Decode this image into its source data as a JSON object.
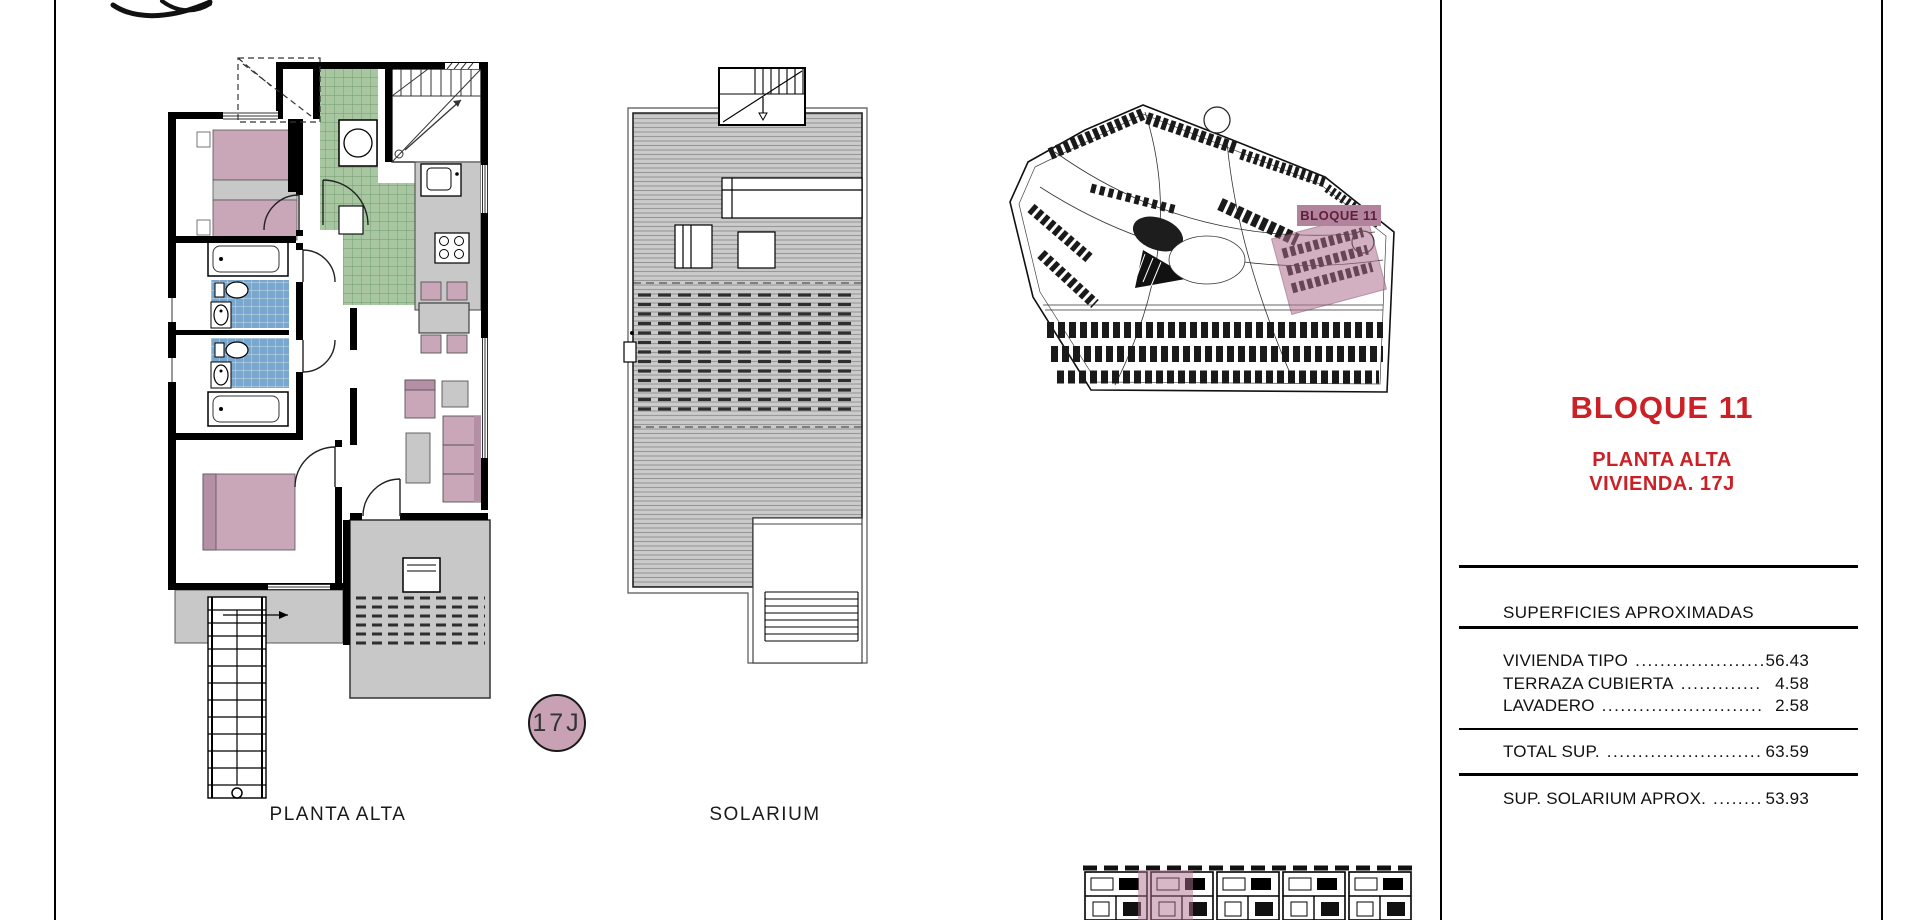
{
  "page": {
    "background": "#ffffff",
    "border_color": "#000000"
  },
  "colors": {
    "accent_red": "#cb2026",
    "mauve": "#c9a6b8",
    "mauve_highlight": "#b0718f",
    "site_tag_bg": "#b2839c",
    "site_tag_text": "#5e1f38",
    "tile_blue": "#79a7ce",
    "tile_green": "#a8c7a0",
    "floor_gray": "#c8c8c8",
    "line_black": "#000000"
  },
  "drawings": {
    "planta_alta": {
      "caption": "PLANTA ALTA"
    },
    "solarium": {
      "caption": "SOLARIUM"
    },
    "unit_badge": {
      "label": "17J"
    },
    "site_plan": {
      "block_tag": "BLOQUE 11"
    }
  },
  "info_panel": {
    "title": "BLOQUE 11",
    "subtitle_line1": "PLANTA ALTA",
    "subtitle_line2": "VIVIENDA. 17J",
    "surfaces": {
      "header": "SUPERFICIES APROXIMADAS",
      "rows": [
        {
          "label": "VIVIENDA TIPO",
          "leader": "..........................",
          "value": "56.43"
        },
        {
          "label": "TERRAZA CUBIERTA",
          "leader": "...................",
          "value": "4.58"
        },
        {
          "label": "LAVADERO",
          "leader": "....................................",
          "value": "2.58"
        }
      ],
      "total": {
        "label": "TOTAL SUP.",
        "leader": "................................",
        "value": "63.59"
      },
      "solarium_row": {
        "label": "SUP. SOLARIUM APROX.",
        "leader": ".........",
        "value": "53.93"
      }
    }
  }
}
